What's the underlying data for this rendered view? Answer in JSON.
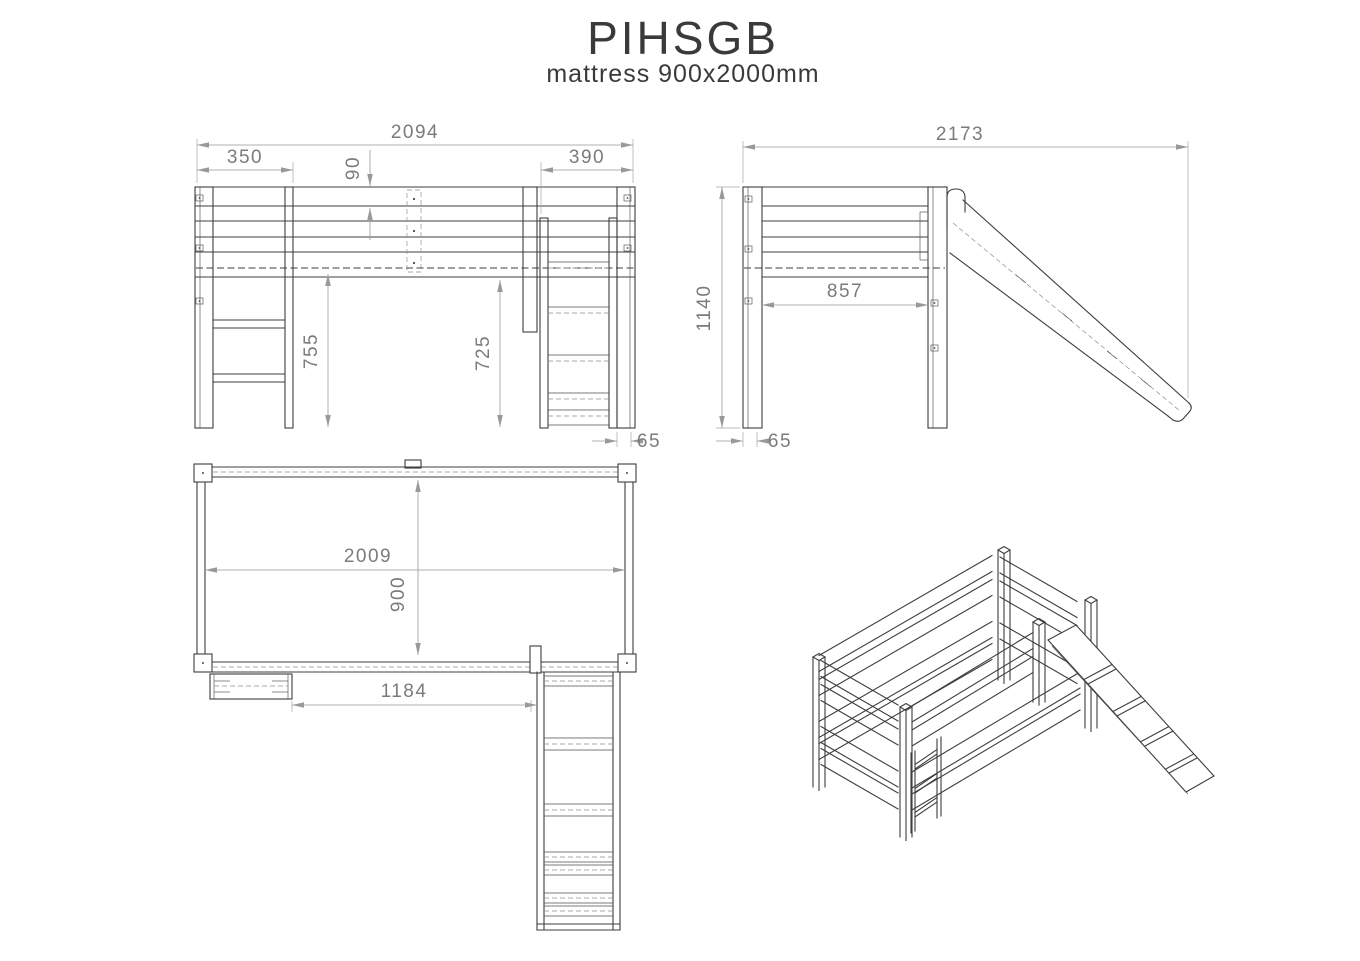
{
  "title": "PIHSGB",
  "subtitle": "mattress 900x2000mm",
  "views": {
    "front": {
      "dims": {
        "overall_width": "2094",
        "ladder_offset": "350",
        "slide_offset": "390",
        "rail_height": "90",
        "clearance_left": "755",
        "clearance_right": "725",
        "side_offset": "65"
      }
    },
    "side": {
      "dims": {
        "overall_depth": "2173",
        "total_height": "1140",
        "inner_depth": "857",
        "post_offset": "65"
      }
    },
    "top": {
      "dims": {
        "bed_length": "2009",
        "bed_width": "900",
        "ladder_to_slide": "1184"
      }
    }
  }
}
